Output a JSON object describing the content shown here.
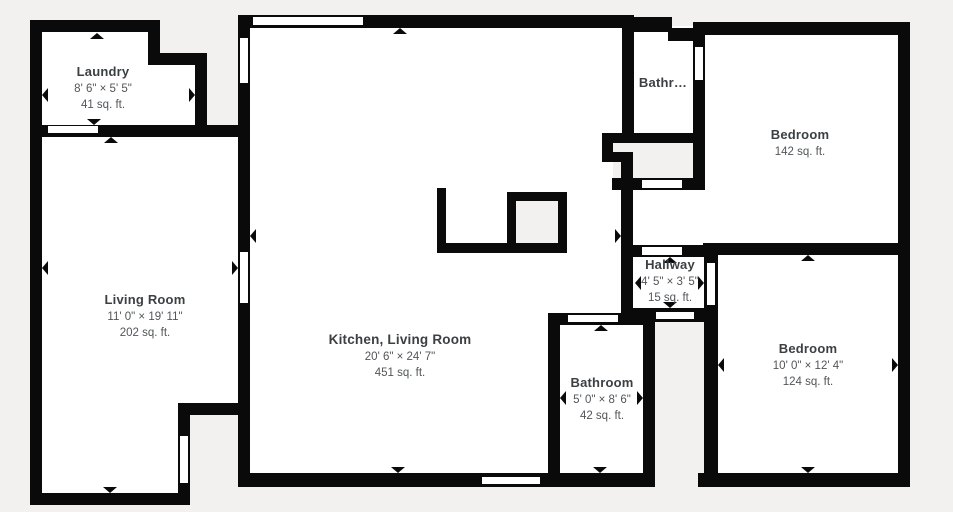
{
  "colors": {
    "background": "#f2f1ef",
    "floor": "#ffffff",
    "wall": "#0a0a0a",
    "text": "#3c4043",
    "subtext": "#52565a"
  },
  "rooms": {
    "laundry": {
      "name": "Laundry",
      "dims": "8' 6\" × 5' 5\"",
      "area": "41 sq. ft."
    },
    "living": {
      "name": "Living Room",
      "dims": "11' 0\" × 19' 11\"",
      "area": "202 sq. ft."
    },
    "kitchen": {
      "name": "Kitchen, Living Room",
      "dims": "20' 6\" × 24' 7\"",
      "area": "451 sq. ft."
    },
    "bathroom_top": {
      "name": "Bathr…"
    },
    "bedroom_top": {
      "name": "Bedroom",
      "area": "142 sq. ft."
    },
    "hallway": {
      "name": "Hallway",
      "dims": "4' 5\" × 3' 5\"",
      "area": "15 sq. ft."
    },
    "bathroom": {
      "name": "Bathroom",
      "dims": "5' 0\" × 8' 6\"",
      "area": "42 sq. ft."
    },
    "bedroom": {
      "name": "Bedroom",
      "dims": "10' 0\" × 12' 4\"",
      "area": "124 sq. ft."
    }
  }
}
